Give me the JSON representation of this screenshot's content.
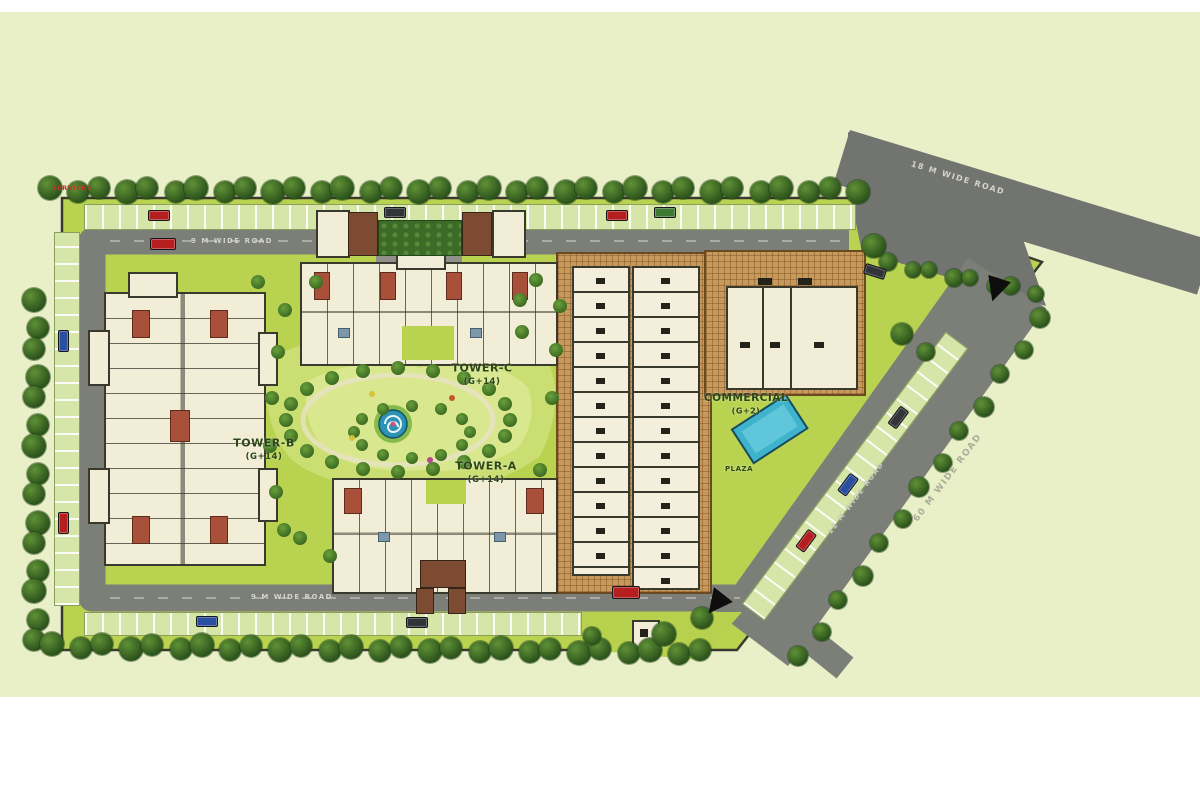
{
  "plan": {
    "title": "Residential Complex Site Plan",
    "towers": [
      {
        "id": "tower-b",
        "name": "TOWER-B",
        "floors": "(G+14)"
      },
      {
        "id": "tower-c",
        "name": "TOWER-C",
        "floors": "(G+14)"
      },
      {
        "id": "tower-a",
        "name": "TOWER-A",
        "floors": "(G+14)"
      }
    ],
    "commercial": {
      "name": "COMMERCIAL",
      "floors": "(G+2)"
    },
    "plaza_label": "PLAZA",
    "services_label": "SERVICES",
    "roads": {
      "top": "9 M WIDE ROAD",
      "bottom": "9 M WIDE ROAD",
      "internal_diagonal": "12 M WIDE ROAD",
      "outer_diagonal": "60 M WIDE ROAD",
      "top_right": "18 M WIDE ROAD"
    },
    "colors": {
      "land": "#e9f0c8",
      "lawn": "#b9d351",
      "road": "#7c7e78",
      "paving": "#c79a5b",
      "building": "#f1edd6",
      "tree": "#2b521b",
      "pool": "#3fb3cc",
      "accent_roof": "#a8503a"
    }
  }
}
